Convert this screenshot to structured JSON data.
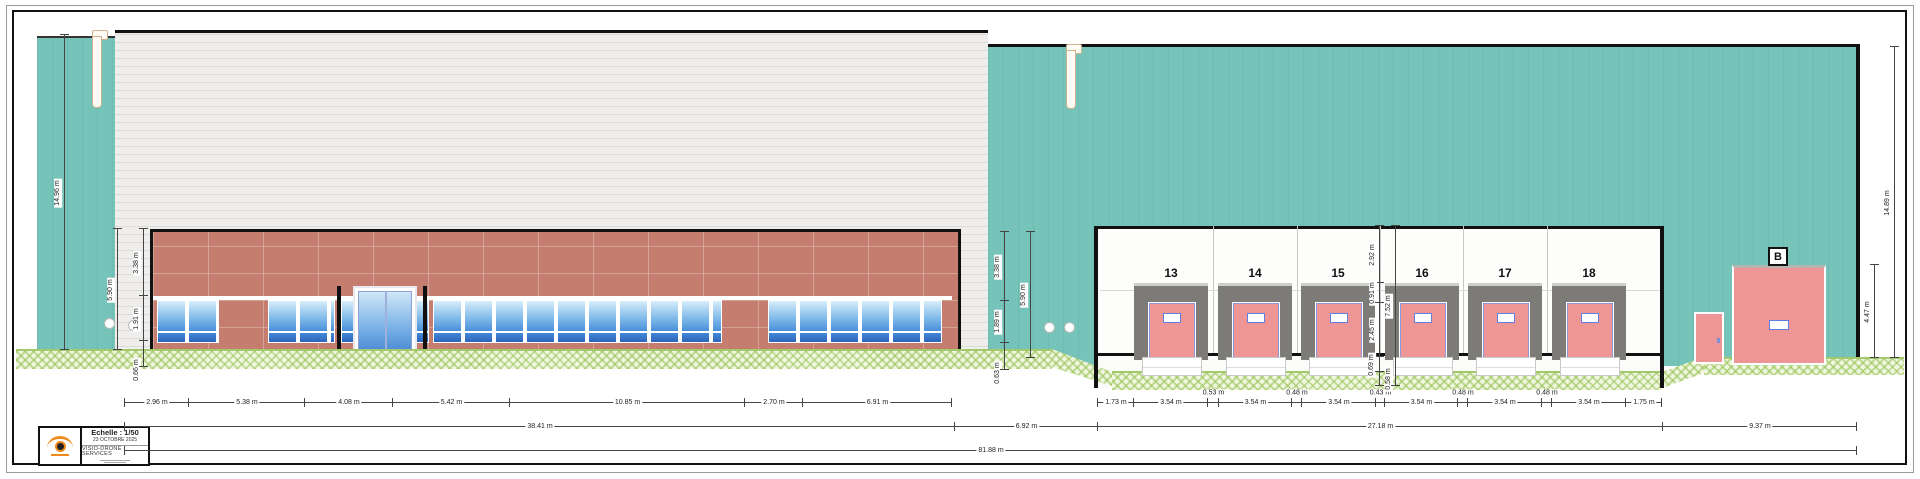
{
  "colors": {
    "teal": "#76c4b9",
    "brick": "#c47d6e",
    "dock_pink": "#ee9596",
    "shelter_grey": "#7c7b77",
    "grass_green": "#a4c86c",
    "logo_orange": "#ef8a1e"
  },
  "title_block": {
    "scale": "Echelle : 1/50",
    "date": "23 OCTOBRE 2025",
    "company": "VISIO-DRONE SERVICES"
  },
  "annex_label": "B",
  "docks": [
    "13",
    "14",
    "15",
    "16",
    "17",
    "18"
  ],
  "dimensions": {
    "bottom_row1_left": [
      "2.96 m",
      "5.38 m",
      "4.08 m",
      "5.42 m",
      "10.85 m",
      "2.70 m",
      "6.91 m"
    ],
    "bottom_row1_right": [
      "1.73 m",
      "3.54 m",
      "0.53 m",
      "3.54 m",
      "0.48 m",
      "3.54 m",
      "0.43 m",
      "3.54 m",
      "0.48 m",
      "3.54 m",
      "0.48 m",
      "3.54 m",
      "1.75 m"
    ],
    "bottom_row2": [
      "38.41 m",
      "6.92 m",
      "27.18 m",
      "9.37 m"
    ],
    "bottom_row3": [
      "81.88 m"
    ],
    "left_overall": "14.96 m",
    "left_total": "5.90 m",
    "left_chain": [
      "3.38 m",
      "1.91 m",
      "0.66 m"
    ],
    "mid_chain": [
      "3.38 m",
      "1.89 m",
      "0.63 m"
    ],
    "mid_total": "5.90 m",
    "dock_chain": [
      "2.92 m",
      "0.91 m",
      "2.45 m",
      "0.69 m",
      "0.58 m"
    ],
    "dock_total": "7.52 m",
    "annex_height": "4.47 m",
    "right_overall": "14.89 m"
  }
}
